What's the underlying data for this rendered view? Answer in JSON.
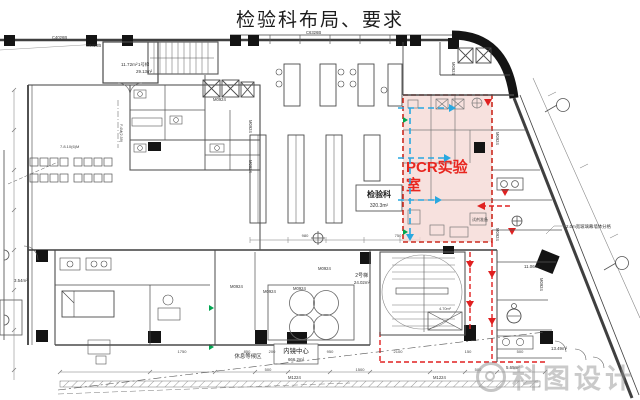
{
  "title": "检验科布局、要求",
  "pcr": {
    "line1": "PCR实验",
    "line2": "室"
  },
  "labels": {
    "jianyanke": "检验科",
    "jianyanke_area": "320.3m²",
    "stair1_name": "1号梯",
    "stair1_area": "29.13m²",
    "stair2_name": "2号梯",
    "stair2_area": "24.02m²",
    "room_1172": "11.72m²",
    "room_354": "3.54m²",
    "room_1106": "11.06m²",
    "room_1349": "13.49m²",
    "room_565": "5.65m²",
    "shaft_area": "4.70m²",
    "rest_area": "休息等候区",
    "endoscopy": "内镜中心",
    "endoscopy_area": "666.2m²",
    "reagent_prep": "试剂准备",
    "curtain_note": "2.0m宽玻璃幕墙体分格",
    "wall_tag": "7.8.10(6)M",
    "setback_tag": "F.4M(2.59)"
  },
  "tags": [
    {
      "t": "C4026B",
      "x": 52,
      "y": 39,
      "r": 0
    },
    {
      "t": "C6326B",
      "x": 86,
      "y": 47,
      "r": 0
    },
    {
      "t": "C6326B",
      "x": 306,
      "y": 34,
      "r": 0
    },
    {
      "t": "M0924",
      "x": 213,
      "y": 101,
      "r": 0
    },
    {
      "t": "M0924",
      "x": 249,
      "y": 120,
      "r": 90
    },
    {
      "t": "M0924",
      "x": 249,
      "y": 160,
      "r": 90
    },
    {
      "t": "M0924",
      "x": 452,
      "y": 62,
      "r": 90
    },
    {
      "t": "M0924",
      "x": 496,
      "y": 132,
      "r": 90
    },
    {
      "t": "M0924",
      "x": 496,
      "y": 228,
      "r": 90
    },
    {
      "t": "M0924",
      "x": 540,
      "y": 278,
      "r": 90
    },
    {
      "t": "M0924",
      "x": 230,
      "y": 288,
      "r": 0
    },
    {
      "t": "M0924",
      "x": 263,
      "y": 293,
      "r": 0
    },
    {
      "t": "M0924",
      "x": 293,
      "y": 290,
      "r": 0
    },
    {
      "t": "M0924",
      "x": 318,
      "y": 270,
      "r": 0
    },
    {
      "t": "M1224",
      "x": 288,
      "y": 379,
      "r": 0
    },
    {
      "t": "M1224",
      "x": 433,
      "y": 379,
      "r": 0
    }
  ],
  "dims_mid": [
    {
      "t": "980",
      "x": 305,
      "y": 237
    },
    {
      "t": "750",
      "x": 398,
      "y": 237
    }
  ],
  "dims_low": [
    {
      "t": "1750",
      "x": 182,
      "y": 353
    },
    {
      "t": "850",
      "x": 247,
      "y": 353
    },
    {
      "t": "200",
      "x": 272,
      "y": 353
    },
    {
      "t": "950",
      "x": 330,
      "y": 353
    },
    {
      "t": "2100",
      "x": 398,
      "y": 353
    },
    {
      "t": "150",
      "x": 468,
      "y": 353
    },
    {
      "t": "500",
      "x": 520,
      "y": 353
    }
  ],
  "dims_bottom": [
    {
      "t": "500",
      "x": 268,
      "y": 371
    },
    {
      "t": "1500",
      "x": 360,
      "y": 371
    },
    {
      "t": "500",
      "x": 478,
      "y": 371
    }
  ],
  "watermark": {
    "text": "科图设计"
  },
  "colors": {
    "pcr_fill": "#f5d9d6",
    "pcr_border": "#cc2a1f",
    "pcr_text": "#e8261f",
    "route_red": "#e02020",
    "route_blue": "#29a8e0",
    "door_green": "#00a650",
    "watermark_gray": "#969696"
  }
}
